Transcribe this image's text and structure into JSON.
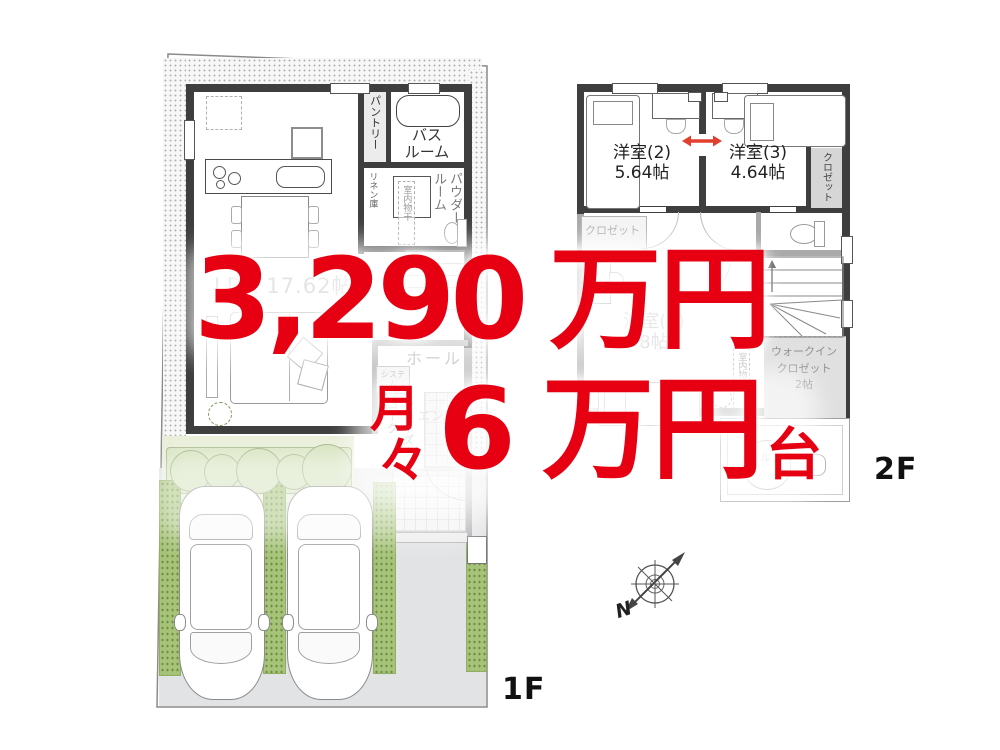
{
  "price_overlay": {
    "color": "#e60012",
    "price_value": "3,290",
    "price_unit": "万円",
    "monthly_char1": "月",
    "monthly_char2": "々",
    "monthly_value": "6",
    "monthly_unit": "万円",
    "monthly_suffix": "台"
  },
  "floor1": {
    "floor_label": "1F",
    "rooms": {
      "ldk": "LDK 17.62帖",
      "pantry": "パントリー",
      "bathroom_line1": "バス",
      "bathroom_line2": "ルーム",
      "linen": "リネン庫",
      "powder_room": "パウダールーム",
      "indoor_drying": "室内物干",
      "hall": "ホール",
      "system_storage_line1": "システム",
      "system_storage_line2": "収納",
      "shoes_cloak": "シューズクローク",
      "entrance": "エントランス"
    }
  },
  "floor2": {
    "floor_label": "2F",
    "rooms": {
      "bedroom2_name": "洋室(2)",
      "bedroom2_size": "5.64帖",
      "bedroom3_name": "洋室(3)",
      "bedroom3_size": "4.64帖",
      "bedroom1_name": "洋室(1)",
      "bedroom1_size": "8帖",
      "closet_right": "クロゼット",
      "closet_bedroom1": "クロゼット",
      "indoor_drying": "室内物干",
      "wic_line1": "ウォークイン",
      "wic_line2": "クロゼット",
      "wic_line3": "2帖",
      "balcony": "バルコニー"
    }
  },
  "compass": {
    "north_label": "N"
  }
}
